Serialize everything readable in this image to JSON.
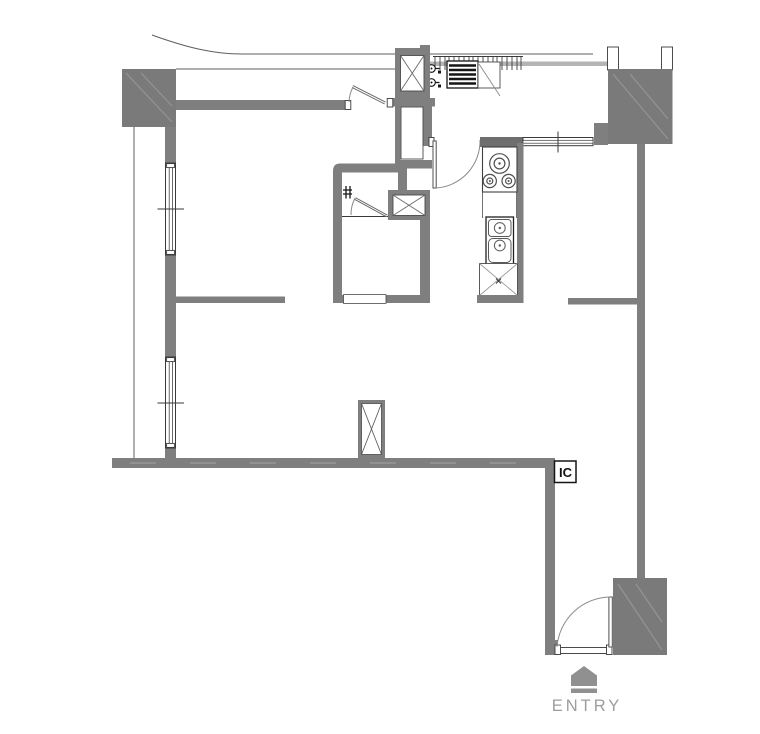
{
  "plan": {
    "labels": {
      "junction_box": "IC",
      "entry": "ENTRY"
    },
    "icons": {
      "entry_marker": "home-pentagon-icon",
      "shafts": "x-cross-shaft",
      "door_swings": "quarter-arc-door"
    },
    "colors": {
      "wall": "#7f7f7f",
      "wall_dark": "#6e6e6e",
      "column": "#7a7a7a",
      "outline": "#3a3a3a",
      "thin_line": "#555555",
      "rail": "#b4b4b4",
      "glyph": "#151515",
      "hatch": "#949494",
      "entry_gray": "#909090",
      "entry_text": "#9d9d9d",
      "background": "#ffffff"
    }
  }
}
